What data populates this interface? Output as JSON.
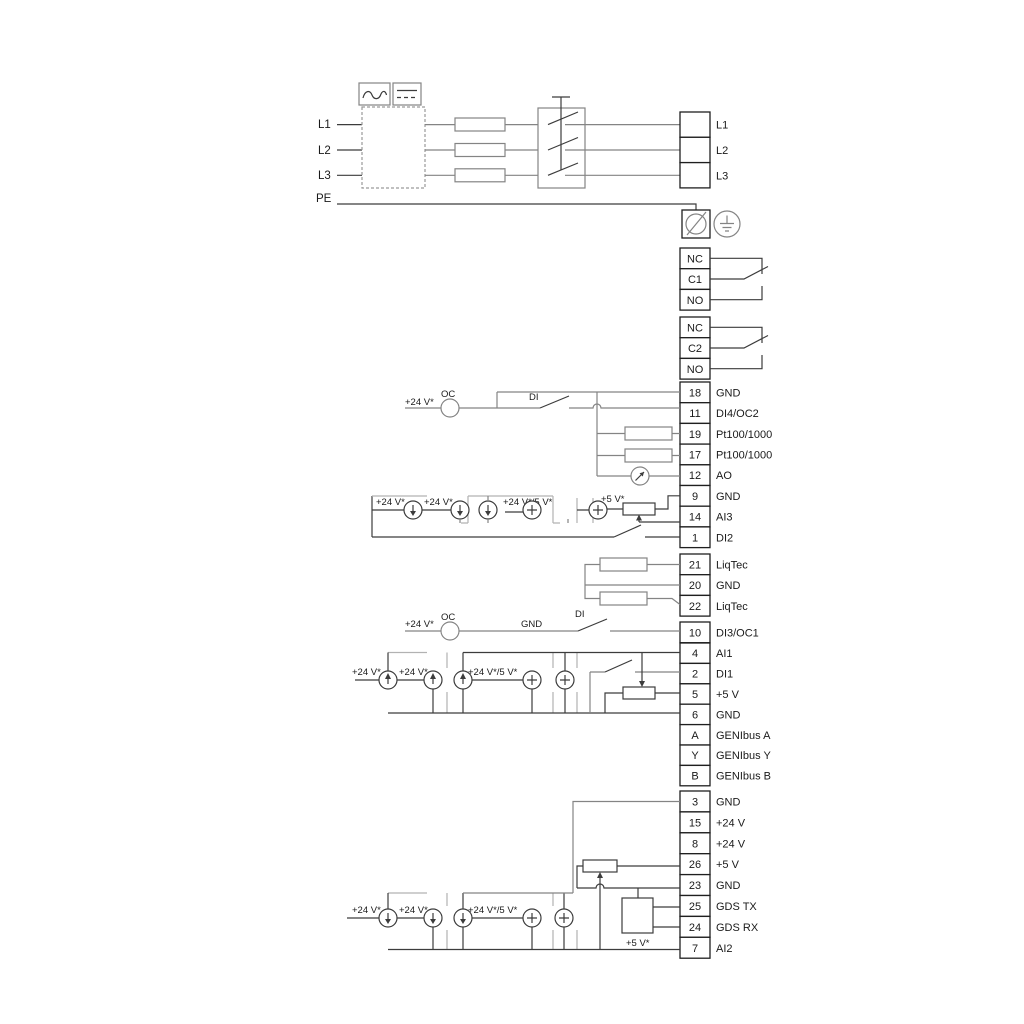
{
  "diagram_title": "drive-wiring-terminal-diagram",
  "power": {
    "inputs": [
      "L1",
      "L2",
      "L3",
      "PE"
    ],
    "outputs": [
      "L1",
      "L2",
      "L3"
    ]
  },
  "relays": [
    {
      "rows": [
        "NC",
        "C1",
        "NO"
      ]
    },
    {
      "rows": [
        "NC",
        "C2",
        "NO"
      ]
    }
  ],
  "strips": {
    "io1": {
      "rows": [
        {
          "no": "18",
          "label": "GND"
        },
        {
          "no": "11",
          "label": "DI4/OC2"
        },
        {
          "no": "19",
          "label": "Pt100/1000"
        },
        {
          "no": "17",
          "label": "Pt100/1000"
        },
        {
          "no": "12",
          "label": "AO"
        },
        {
          "no": "9",
          "label": "GND"
        },
        {
          "no": "14",
          "label": "AI3"
        },
        {
          "no": "1",
          "label": "DI2"
        }
      ]
    },
    "liqtec": {
      "rows": [
        {
          "no": "21",
          "label": "LiqTec"
        },
        {
          "no": "20",
          "label": "GND"
        },
        {
          "no": "22",
          "label": "LiqTec"
        }
      ]
    },
    "di3": {
      "rows": [
        {
          "no": "10",
          "label": "DI3/OC1"
        }
      ]
    },
    "io2": {
      "rows": [
        {
          "no": "4",
          "label": "AI1"
        },
        {
          "no": "2",
          "label": "DI1"
        },
        {
          "no": "5",
          "label": "+5 V"
        },
        {
          "no": "6",
          "label": "GND"
        },
        {
          "no": "A",
          "label": "GENIbus A"
        },
        {
          "no": "Y",
          "label": "GENIbus Y"
        },
        {
          "no": "B",
          "label": "GENIbus B"
        }
      ]
    },
    "io3": {
      "rows": [
        {
          "no": "3",
          "label": "GND"
        },
        {
          "no": "15",
          "label": "+24 V"
        },
        {
          "no": "8",
          "label": "+24 V"
        },
        {
          "no": "26",
          "label": "+5 V"
        },
        {
          "no": "23",
          "label": "GND"
        },
        {
          "no": "25",
          "label": "GDS TX"
        },
        {
          "no": "24",
          "label": "GDS RX"
        },
        {
          "no": "7",
          "label": "AI2"
        }
      ]
    }
  },
  "ann": {
    "v24": "+24 V*",
    "v24_5": "+24 V*/5 V*",
    "v5": "+5 V*",
    "oc": "OC",
    "di": "DI",
    "gnd": "GND"
  },
  "colors": {
    "wire": "#848484",
    "dark": "#3c3c3c",
    "bracket": "#b2b2b2",
    "text": "#1a1a1a"
  }
}
